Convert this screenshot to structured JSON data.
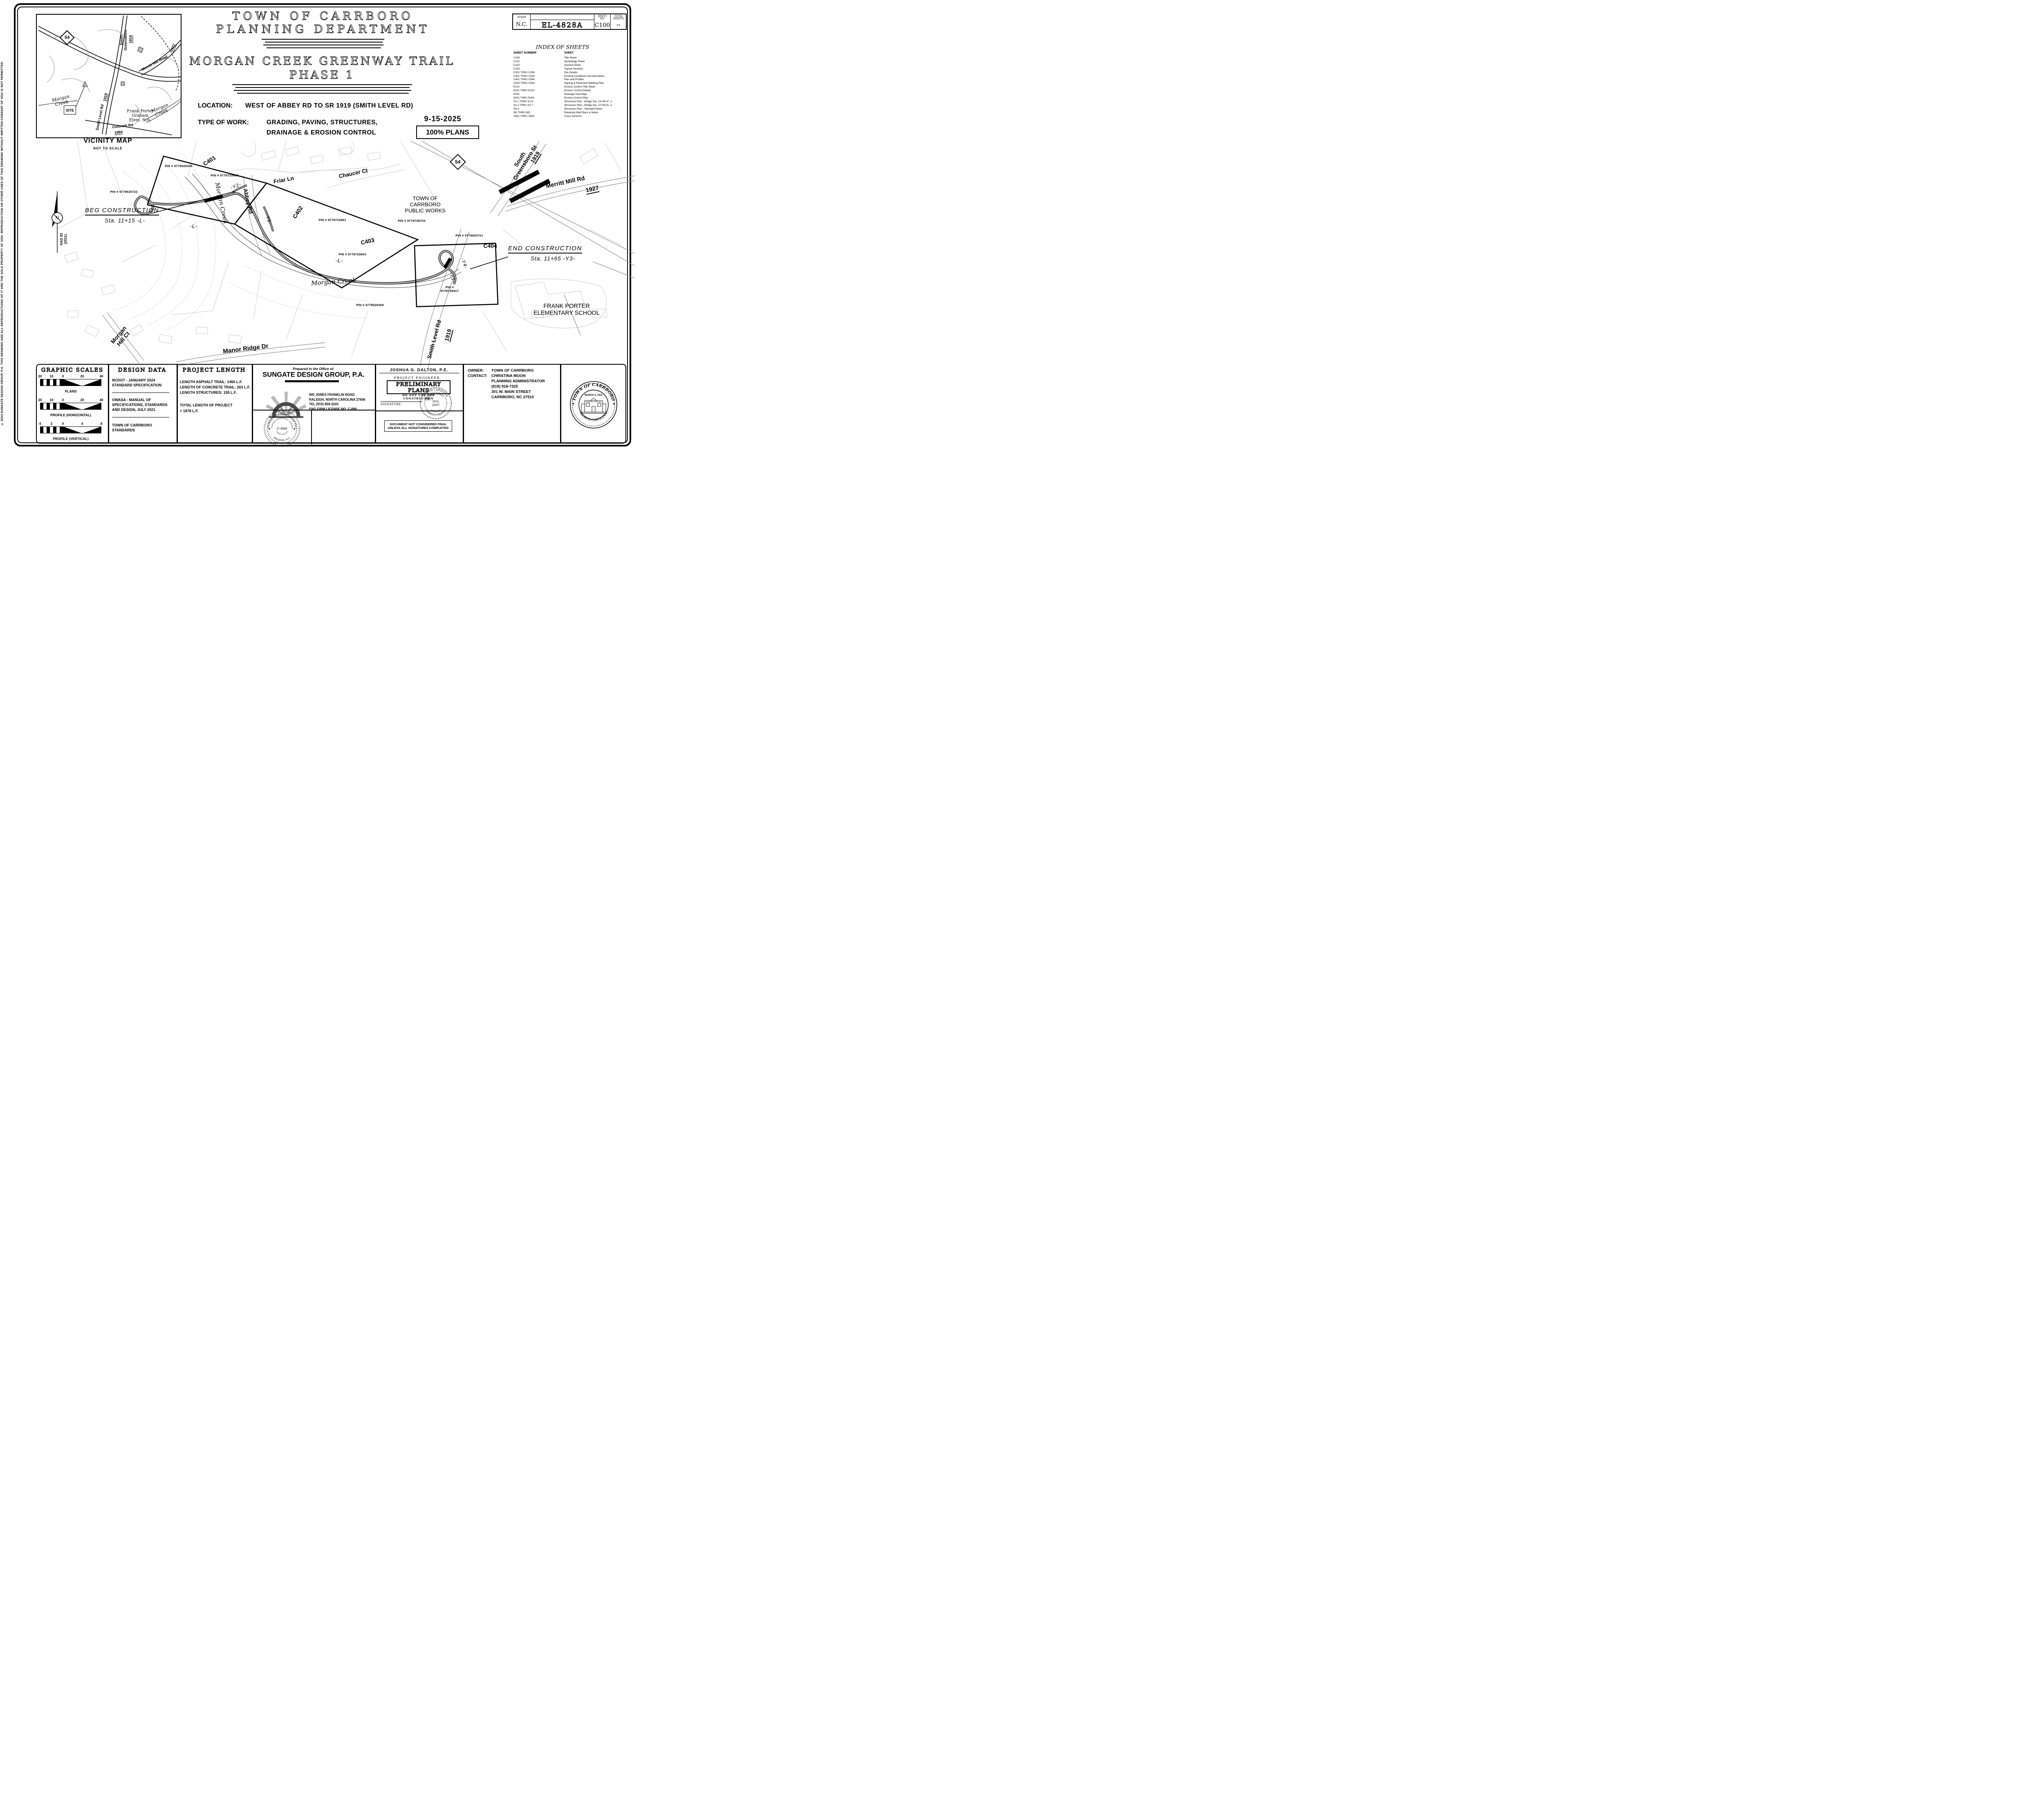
{
  "frame": {
    "copyright": "© 2024 SUNGATE DESIGN GROUP, P.A.   THIS DRAWING AND ALL REPRODUCTIONS OF IT ARE THE SOLE PROPERTY OF SDG. REPRODUCTION OR OTHER USES OF THIS DRAWING WITHOUT WRITTEN CONSENT OF SDG IS NOT PERMITTED."
  },
  "sheet_info": {
    "state_label": "STATE",
    "state_value": "N.C.",
    "project_number": "EL-4828A",
    "sheet_no_label_1": "SHEET",
    "sheet_no_label_2": "NO.",
    "sheet_no_value": "C100",
    "total_label_1": "TOTAL",
    "total_label_2": "SHEETS",
    "total_value": "--"
  },
  "titles": {
    "agency_line1": "TOWN OF CARRBORO",
    "agency_line2": "PLANNING DEPARTMENT",
    "project_line1": "MORGAN CREEK GREENWAY TRAIL",
    "project_line2": "PHASE 1"
  },
  "project_info": {
    "location_label": "LOCATION:",
    "location_value": "WEST OF ABBEY RD TO SR 1919 (SMITH LEVEL RD)",
    "work_label": "TYPE OF WORK:",
    "work_line1": "GRADING, PAVING, STRUCTURES,",
    "work_line2": "DRAINAGE & EROSION CONTROL",
    "date": "9-15-2025",
    "status": "100% PLANS"
  },
  "index_of_sheets": {
    "title": "INDEX OF SHEETS",
    "col_number": "SHEET NUMBER",
    "col_sheet": "SHEET",
    "rows": [
      [
        "C100",
        "Title Sheet"
      ],
      [
        "C101",
        "Symbology Sheet"
      ],
      [
        "C102",
        "General Notes"
      ],
      [
        "C103",
        "Typical Sections"
      ],
      [
        "C201 THRU C206",
        "Site Details"
      ],
      [
        "C301 THRU C304",
        "Existing Conditions and Demolition"
      ],
      [
        "C401 THRU C404",
        "Plan and Profiles"
      ],
      [
        "C500 THRU C504",
        "Signing & Pavement Marking Plan"
      ],
      [
        "E101",
        "Erosion Control Title Sheet"
      ],
      [
        "E201 THRU E210",
        "Erosion Control Details"
      ],
      [
        "E301",
        "Drainage Area Map"
      ],
      [
        "E401 THRU E404",
        "Erosion Control Plan"
      ],
      [
        "S1-1 THRU S1-8",
        "Structures Plan - Bridge Sta. 13+38.47 -L-"
      ],
      [
        "S2-1 THRU S2-7",
        "Structures Plan - Bridge Sta. 27+06.91 -L-"
      ],
      [
        "SN-1",
        "Structures Plan - Standard Notes"
      ],
      [
        "W1 THRU W5",
        "Retaining Wall Plans & Notes"
      ],
      [
        "X501 THRU X509",
        "Cross Sections"
      ]
    ]
  },
  "vicinity": {
    "title": "VICINITY MAP",
    "subtitle": "NOT TO SCALE",
    "route54": "54",
    "south_greensboro_1": "South",
    "south_greensboro_2": "Greensboro",
    "sr1919": "1919",
    "merritt_mill": "Merritt Mill Road",
    "sr1927": "1927",
    "morgan_creek_w_1": "Morgan",
    "morgan_creek_w_2": "Creek",
    "site": "SITE",
    "smith_level": "Smith Level Rd",
    "sr1919b": "1919",
    "school_1": "Frank Porter",
    "school_2": "Graham",
    "school_3": "Elem. Sch.",
    "morgan_creek_e_1": "Morgan",
    "morgan_creek_e_2": "Creek",
    "culbreth": "Culbreth Rd",
    "sr1994": "1994"
  },
  "plan": {
    "c401": "C401",
    "c402": "C402",
    "c403": "C403",
    "c404": "C404",
    "beg_1": "BEG CONSTRUCTION",
    "beg_2": "Sta. 11+15  -L-",
    "end_1": "END CONSTRUCTION",
    "end_2": "Sta. 11+65  -Y3-",
    "pin_west": "PIN # 9778625722",
    "pin_nw": "PIN # 9778629408",
    "pin_n": "PIN # 9778723603",
    "pin_center": "PIN # 9778723603",
    "pin_ne": "PIN # 9778723881",
    "pin_pw": "PIN # 9778728704",
    "pin_e": "PIN # 9778820701",
    "pin_se_1": "PIN #",
    "pin_se_2": "9778729417",
    "pin_s": "PIN # 9778629408",
    "north_n": "N",
    "datum_1": "NAD 83",
    "datum_2": "(2011)",
    "morgan_creek_up": "Morgan Creek",
    "morgan_creek_mid": "Morgan Creek",
    "abbey_rd": "Abbey Rd",
    "friar_ln": "Friar Ln",
    "chaucer_ct": "Chaucer Ct",
    "y2": "-Y2-",
    "y5": "-Y5-",
    "y4": "-Y4-",
    "y3": "-Y3-",
    "l_up": "-L-",
    "l_mid": "-L-",
    "route54": "54",
    "sgreensboro_1": "South",
    "sgreensboro_2": "Greensboro St",
    "sr1919_n": "1919",
    "merritt_mill": "Merritt Mill Rd",
    "sr1927": "1927",
    "public_works_1": "TOWN OF",
    "public_works_2": "CARRBORO",
    "public_works_3": "PUBLIC WORKS",
    "school_1": "FRANK PORTER",
    "school_2": "ELEMENTARY SCHOOL",
    "smith_level": "Smith Level Rd",
    "sr1919_s": "1919",
    "morgan_hill_1": "Morgan",
    "morgan_hill_2": "Hill Ct",
    "manor_ridge": "Manor Ridge Dr"
  },
  "scales": {
    "title": "GRAPHIC SCALES",
    "bars": [
      {
        "t0": "20",
        "t1": "10",
        "t2": "0",
        "t3": "20",
        "t4": "40",
        "caption": "PLANS"
      },
      {
        "t0": "20",
        "t1": "10",
        "t2": "0",
        "t3": "20",
        "t4": "40",
        "caption": "PROFILE (HORIZONTAL)"
      },
      {
        "t0": "4",
        "t1": "2",
        "t2": "0",
        "t3": "4",
        "t4": "8",
        "caption": "PROFILE (VERTICAL)"
      }
    ]
  },
  "design_data": {
    "title": "DESIGN DATA",
    "item1_1": "NCDOT - JANUARY 2024",
    "item1_2": "STANDARD SPECIFICATION",
    "item2_1": "OWASA - MANUAL OF",
    "item2_2": "SPECIFICATIONS, STANDARDS",
    "item2_3": "AND DESIGN, JULY 2021",
    "item3_1": "TOWN OF CARRBORO",
    "item3_2": "STANDARDS"
  },
  "project_length": {
    "title": "PROJECT LENGTH",
    "line1": "LENGTH ASPHALT TRAIL: 1460 L.F.",
    "line2": "LENGTH OF CONCRETE TRAIL: 263 L.F.",
    "line3": "LENGTH STRUCTURES: 155 L.F.",
    "total_1": "TOTAL LENGTH OF PROJECT",
    "total_2": "= 1878 L.F."
  },
  "prepared": {
    "preamble": "Prepared In the Office of:",
    "firm": "SUNGATE DESIGN GROUP, P.A.",
    "addr1": "905 JONES FRANKLIN ROAD",
    "addr2": "RALEIGH, NORTH CAROLINA 27606",
    "addr3": "TEL (919) 859-2243",
    "addr4": "ENG FIRM LICENSE NO. C-890",
    "seal_top": "SUNGATE DESIGN GROUP P.A.",
    "seal_mid": "PROFESSIONAL ENGINEERING CORPORATION",
    "seal_center": "C-890",
    "seal_nc": "NORTH CAROLINA",
    "seal_bottom": "RALEIGH, N.C."
  },
  "engineer": {
    "name": "JOSHUA G. DALTON,  P.E.",
    "role": "PROJECT ENGINEER",
    "stamp_1": "PRELIMINARY PLANS",
    "stamp_2": "DO NOT USE FOR CONSTRUCTION",
    "signature_label": "SIGNATURE:",
    "pe": "P.E.",
    "seal_top": "NORTH CAROLINA",
    "seal_mid": "PROFESSIONAL",
    "seal_word": "SEAL",
    "seal_no": "2697",
    "seal_eng": "ENGINEER",
    "seal_name": "JOSHUA G. DALTON",
    "note_1": "DOCUMENT NOT CONSIDERED FINAL",
    "note_2": "UNLESS ALL SIGNATURES COMPLETED"
  },
  "owner": {
    "owner_label": "OWNER:",
    "owner_value": "TOWN OF CARRBORO",
    "contact_label": "CONTACT:",
    "contact_value": "CHRISTINA MOON",
    "line3": "PLANNING ADMINISTRATOR",
    "line4": "(919) 918-7325",
    "line5": "301 W. MAIN STREET",
    "line6": "CARRBORO, NC 27510"
  },
  "town_seal": {
    "arc_top": "• TOWN OF CARRBORO •",
    "arc_bottom": "NORTH CAROLINA",
    "date": "MARCH 3, 1911",
    "hall": "CARRBORO TOWN HALL"
  }
}
